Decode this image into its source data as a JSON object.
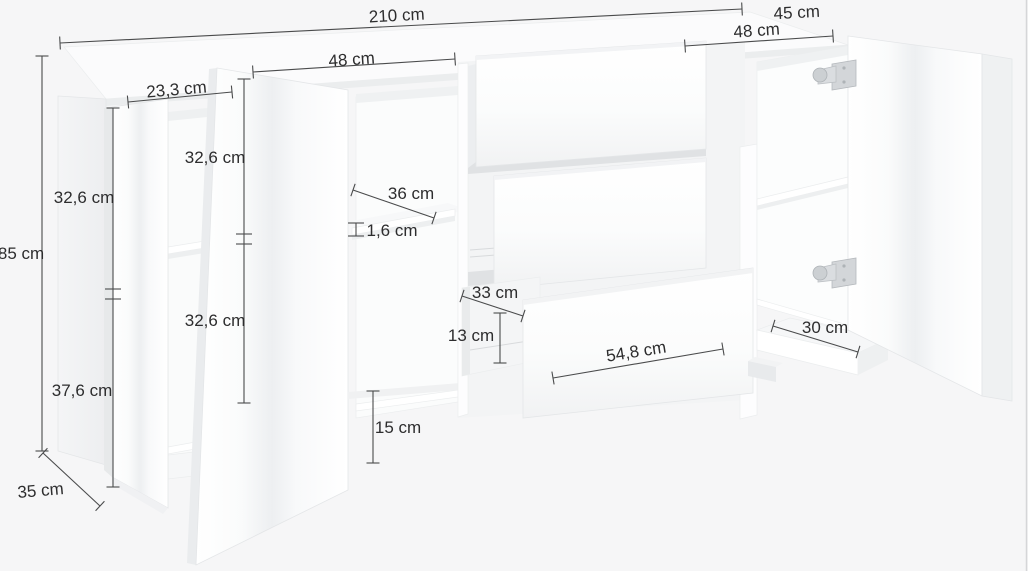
{
  "diagram": {
    "type": "furniture-dimension-diagram",
    "product": "sideboard",
    "unit": "cm",
    "colors": {
      "background": "#f6f6f7",
      "furniture": "#ffffff",
      "shading": "#e9ebed",
      "dimension_lines": "#4a4b4c",
      "text": "#2d2d2e"
    },
    "annotations": [
      {
        "id": "total-width",
        "label": "210 cm"
      },
      {
        "id": "top-depth",
        "label": "45 cm"
      },
      {
        "id": "right-door-width",
        "label": "48 cm"
      },
      {
        "id": "left-door-width",
        "label": "48 cm"
      },
      {
        "id": "left-compartment-width",
        "label": "23,3 cm"
      },
      {
        "id": "total-height",
        "label": "85 cm"
      },
      {
        "id": "left-upper-compartment-height",
        "label": "32,6 cm"
      },
      {
        "id": "left-lower-section-height",
        "label": "37,6 cm"
      },
      {
        "id": "middle-upper-compartment-height",
        "label": "32,6 cm"
      },
      {
        "id": "middle-lower-compartment-height",
        "label": "32,6 cm"
      },
      {
        "id": "shelf-depth",
        "label": "36 cm"
      },
      {
        "id": "shelf-thickness",
        "label": "1,6 cm"
      },
      {
        "id": "drawer-inner-depth",
        "label": "33 cm"
      },
      {
        "id": "drawer-inner-height",
        "label": "13 cm"
      },
      {
        "id": "drawer-front-width",
        "label": "54,8 cm"
      },
      {
        "id": "open-plinth-height",
        "label": "15 cm"
      },
      {
        "id": "right-base-depth",
        "label": "30 cm"
      },
      {
        "id": "left-base-depth",
        "label": "35 cm"
      }
    ],
    "hardware": [
      "door-hinge-top",
      "door-hinge-bottom"
    ]
  }
}
